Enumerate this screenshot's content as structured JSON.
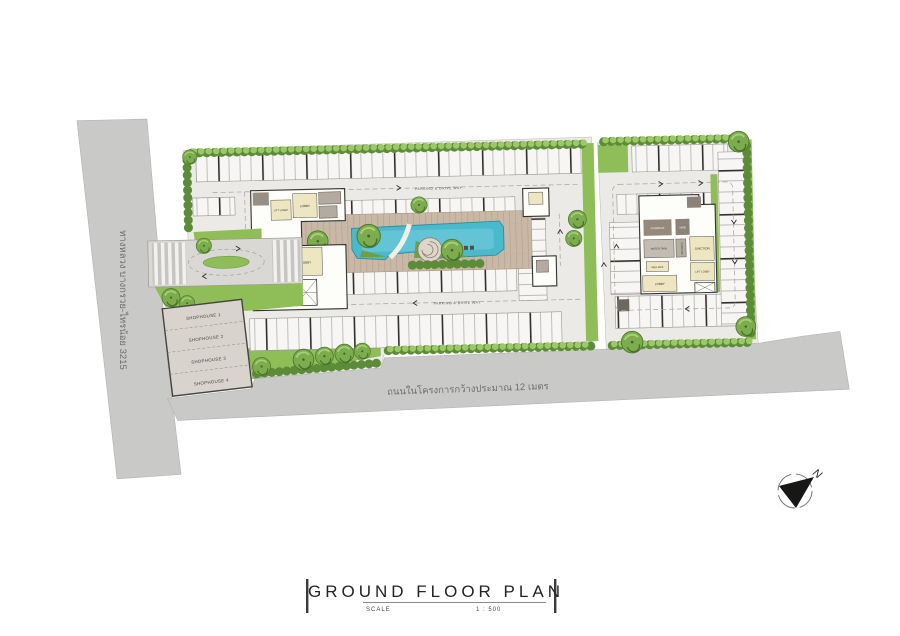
{
  "title_block": {
    "title": "GROUND FLOOR PLAN",
    "scale_label": "SCALE",
    "scale_value": "1 : 500"
  },
  "north": {
    "label": "N"
  },
  "roads": {
    "highway_label": "ทางหลวง บางกรวย-ไทรน้อย 3215",
    "internal_label": "ถนนในโครงการกว้างประมาณ 12 เมตร"
  },
  "parking": {
    "aisle_label": "PARKING & DRIVE WAY"
  },
  "shophouses": {
    "items": [
      {
        "label": "SHOPHOUSE 1"
      },
      {
        "label": "SHOPHOUSE 2"
      },
      {
        "label": "SHOPHOUSE 3"
      },
      {
        "label": "SHOPHOUSE 4"
      }
    ]
  },
  "building_a": {
    "rooms": {
      "lift_lobby": "LIFT LOBBY",
      "lobby_upper": "LOBBY",
      "junction": "JUNCTION",
      "lobby_lower": "LOBBY",
      "mail_box": "MAIL BOX"
    }
  },
  "building_b": {
    "rooms": {
      "garbage": "GARBAGE",
      "mdb": "MDB",
      "water_tank": "WATER TANK",
      "pump": "PUMP RM.",
      "junction": "JUNCTION",
      "mail_box": "MAIL BOX",
      "lobby": "LOBBY",
      "lift_lobby": "LIFT LOBBY"
    }
  },
  "colors": {
    "road": "#c9c9c7",
    "site_paving": "#eceae7",
    "stall": "#f7f6f4",
    "lawn": "#8fbe58",
    "hedge": "#5d8c38",
    "pool": "#49b9cc",
    "pool_light": "#7ccfdd",
    "deck": "#c9b8a6",
    "room_beige": "#ede6c0",
    "room_gray": "#b3aaa0",
    "room_dark": "#86796c",
    "wall": "#33332e"
  }
}
